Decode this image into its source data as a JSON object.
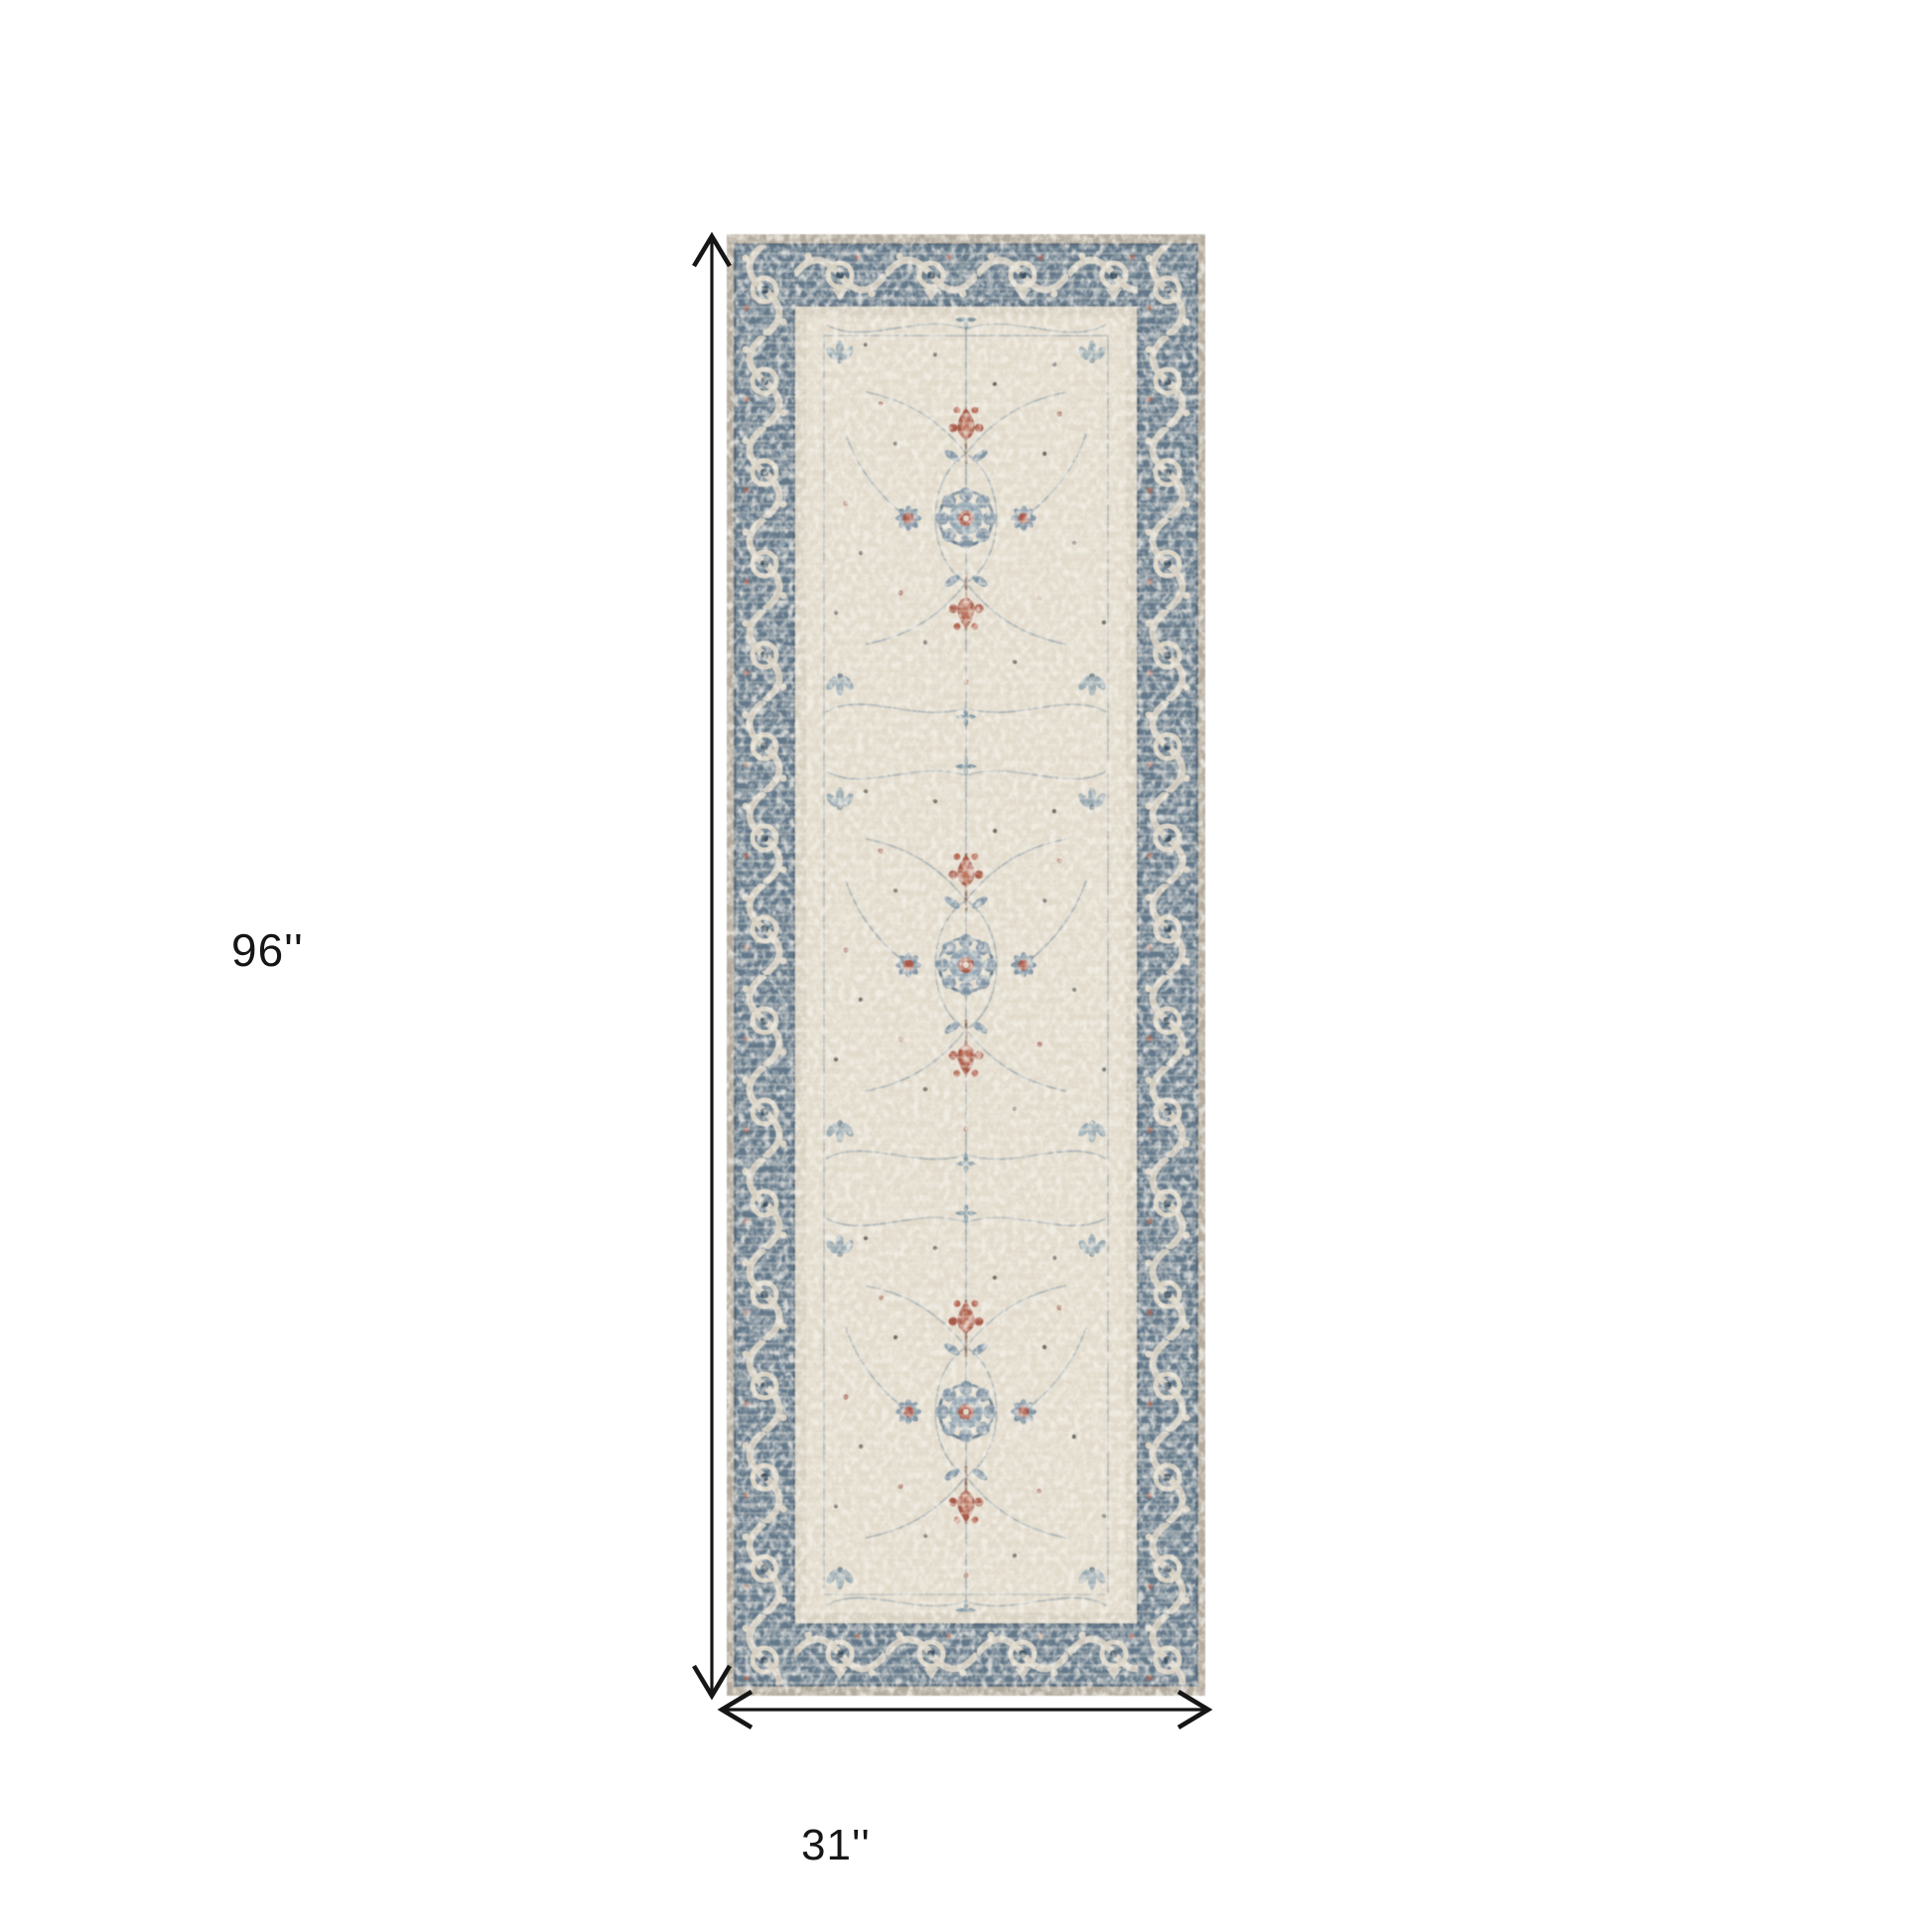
{
  "page": {
    "type": "product-dimensions-diagram",
    "background": "#ffffff"
  },
  "dimensions": {
    "height_label": "96''",
    "width_label": "31''"
  },
  "rug": {
    "name": "distressed-vintage-runner-rug",
    "colors": {
      "outer_edge": "#b3ab9e",
      "border_blue": "#63788a",
      "border_ornament_ivory": "#d7d0c1",
      "border_accent_dark": "#3d5162",
      "guard_ivory": "#d8d1c2",
      "field_ivory": "#e2dbcc",
      "motif_blue": "#7e93a4",
      "motif_red": "#a85a49",
      "vine_gray": "#a7b0b4"
    }
  },
  "annotation": {
    "arrow_color": "#161616",
    "text_color": "#161616"
  }
}
